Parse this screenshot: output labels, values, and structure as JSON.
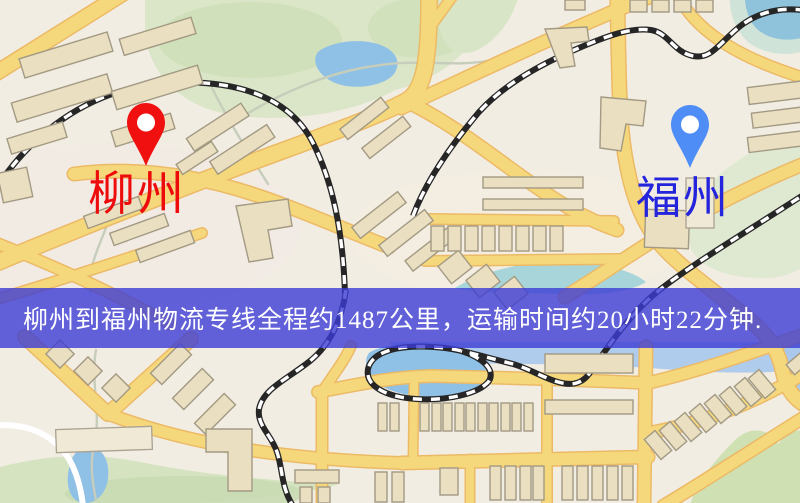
{
  "markers": {
    "origin": {
      "label": "柳州",
      "pin_color": "#f01010",
      "label_color": "#ee0b0b"
    },
    "destination": {
      "label": "福州",
      "pin_color": "#4f8df6",
      "label_color": "#2424dc"
    }
  },
  "banner": {
    "text": "柳州到福州物流专线全程约1487公里，运输时间约20小时22分钟.",
    "background_color": "#3c3cd4",
    "text_color": "#ffffff"
  },
  "route": {
    "origin": "柳州",
    "destination": "福州",
    "distance": "1487公里",
    "duration": "20小时22分钟"
  },
  "map_palette": {
    "background": "#f2ede3",
    "road_fill": "#f6d87c",
    "road_edge": "#ecba66",
    "park_green": "#dbe6c8",
    "water_blue": "#8fc0e6",
    "building_fill": "#eadfc0",
    "railway_dark": "#262626"
  }
}
